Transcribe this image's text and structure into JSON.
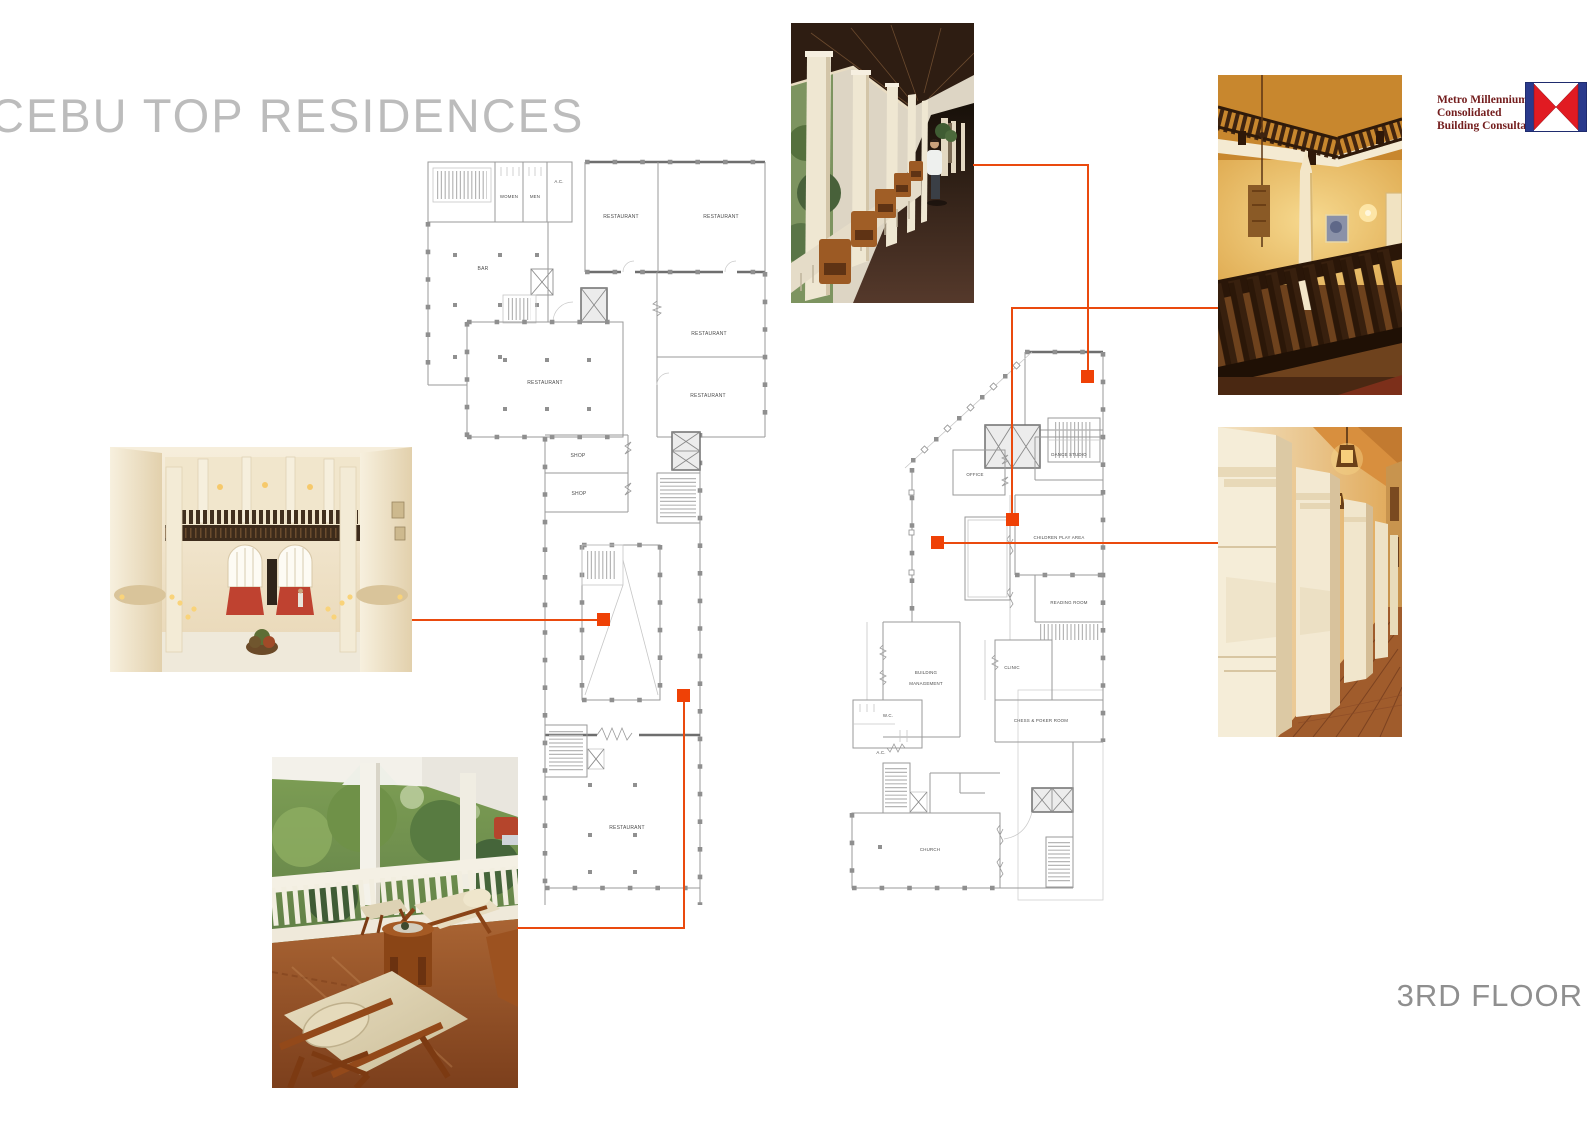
{
  "board": {
    "title": "CEBU TOP RESIDENCES",
    "floor_label": "3RD FLOOR"
  },
  "logo": {
    "line1": "Metro Millennium",
    "line2": "Consolidated",
    "line3": "Building Consultants Ltd."
  },
  "colors": {
    "accent_orange": "#ea4a0e",
    "marker_orange": "#ef4106",
    "logo_text": "#731d1d",
    "logo_red": "#e11b22",
    "logo_blue": "#2a3a8c",
    "title_gray": "#bcbcbc",
    "plan_gray": "#8f8f8f"
  },
  "plans": {
    "left": {
      "labels": {
        "women": "WOMEN",
        "men": "MEN",
        "ac": "A.C.",
        "restaurant": "RESTAURANT",
        "bar": "BAR",
        "shop": "SHOP"
      }
    },
    "right": {
      "labels": {
        "office": "OFFICE",
        "dance_studio": "DANCE STUDIO",
        "children_play_area": "CHILDREN PLAY AREA",
        "reading_room": "READING ROOM",
        "building_line1": "BUILDING",
        "building_line2": "MANAGEMENT",
        "clinic": "CLINIC",
        "wc": "W.C.",
        "ac": "A.C.",
        "chess_poker": "CHESS & POKER ROOM",
        "church": "CHURCH"
      }
    }
  }
}
